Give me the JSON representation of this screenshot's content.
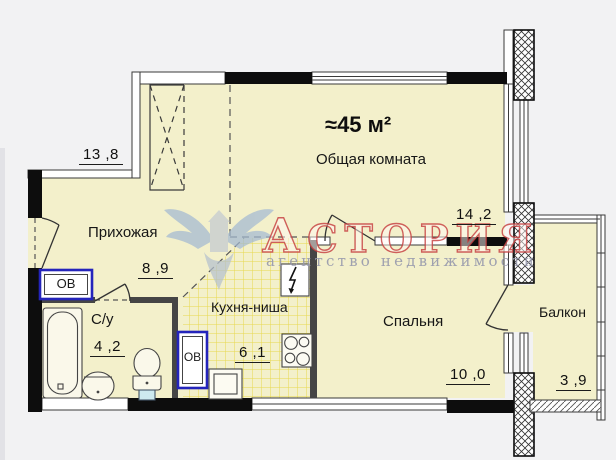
{
  "plan": {
    "total_area": "≈45 м²",
    "rooms": {
      "common": {
        "name": "Общая комната",
        "dim_top": "13 ,8",
        "dim_right": "14 ,2"
      },
      "hallway": {
        "name": "Прихожая",
        "dim": "8 ,9"
      },
      "bathroom": {
        "name": "С/у",
        "dim": "4 ,2"
      },
      "kitchen": {
        "name": "Кухня-ниша",
        "dim": "6 ,1"
      },
      "bedroom": {
        "name": "Спальня",
        "dim": "10 ,0"
      },
      "balcony": {
        "name": "Балкон",
        "dim": "3 ,9"
      }
    },
    "heating_unit_label": "ОВ",
    "watermark": {
      "brand": "АСТОРИЯ",
      "tagline": "агентство недвижимости"
    },
    "colors": {
      "room_fill": "#f3f0cb",
      "tile_line": "#e7d84e",
      "wall": "#0d0d0d",
      "heating_border": "#2424bb",
      "watermark_red": "#c63e3e"
    }
  }
}
